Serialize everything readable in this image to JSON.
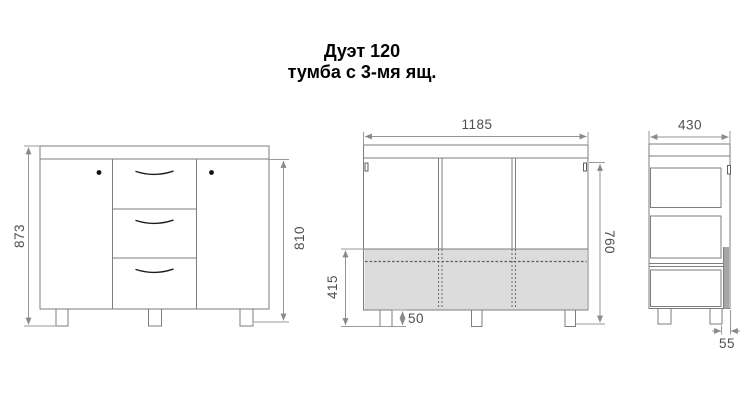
{
  "title": {
    "line1": "Дуэт 120",
    "line2": "тумба с 3-мя ящ."
  },
  "dimensions": {
    "front_total_height_mm": "873",
    "front_body_height_mm": "810",
    "carcass_width_mm": "1185",
    "drawer_zone_height_mm": "415",
    "leg_height_mm": "50",
    "carcass_side_height_mm": "760",
    "depth_mm": "430",
    "back_clearance_mm": "55"
  },
  "colors": {
    "line": "#7e7e7e",
    "dimension_line": "#949494",
    "dimension_text": "#4f4f4f",
    "shade_fill": "#dcdcdc",
    "back_panel_strip": "#a6a6a6",
    "title_text": "#000000"
  }
}
